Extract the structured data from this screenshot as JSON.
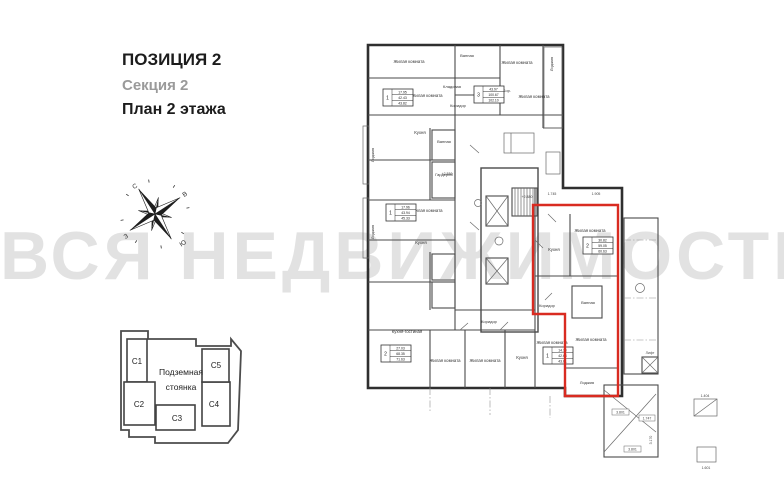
{
  "header": {
    "title": "ПОЗИЦИЯ 2",
    "subtitle": "Секция 2",
    "plan_label": "План 2 этажа"
  },
  "watermark": {
    "text": "ВСЯ НЕДВИЖИМОСТЬ",
    "color": "#e2e2e2"
  },
  "compass": {
    "north": "С",
    "east": "В",
    "west": "З",
    "south": "Ю"
  },
  "minimap": {
    "parking_line1": "Подземная",
    "parking_line2": "стоянка",
    "highlight_fill": "#a8a8a8",
    "sections": [
      {
        "label": "С1"
      },
      {
        "label": "С2"
      },
      {
        "label": "С3"
      },
      {
        "label": "С4"
      },
      {
        "label": "С5"
      }
    ],
    "highlighted": "С2"
  },
  "plan": {
    "highlight_color": "#d92b21",
    "levels": {
      "l1": "+2.880",
      "l2": "+2.880"
    },
    "lift_label": "Лифт",
    "dims": {
      "d1": "1.745",
      "d2": "1.905",
      "d3": "3.801",
      "d4": "1.747",
      "d5": "3.170",
      "d6": "3.801",
      "d9": "1.404",
      "d10": "1.601"
    },
    "apartments": [
      {
        "rooms": "1",
        "a1": "17.95",
        "a2": "42.43",
        "a3": "43.82"
      },
      {
        "rooms": "1",
        "a1": "17.96",
        "a2": "43.94",
        "a3": "45.33"
      },
      {
        "rooms": "3",
        "a1": "43.97",
        "a2": "100.67",
        "a3": "102.10"
      },
      {
        "rooms": "2",
        "a1": "27.03",
        "a2": "68.35",
        "a3": "71.63"
      },
      {
        "rooms": "1",
        "a1": "14.10",
        "a2": "42.64",
        "a3": "43.61"
      },
      {
        "rooms": "2",
        "a1": "30.82",
        "a2": "59.05",
        "a3": "60.63"
      }
    ],
    "rooms": [
      {
        "label": "Жилая комната"
      },
      {
        "label": "Ванная"
      },
      {
        "label": "Жилая комната"
      },
      {
        "label": "Лоджия"
      },
      {
        "label": "Кладовая"
      },
      {
        "label": "Жилая комната"
      },
      {
        "label": "Коридор"
      },
      {
        "label": "Кор."
      },
      {
        "label": "Жилая комната"
      },
      {
        "label": "Кухня"
      },
      {
        "label": "Лоджия"
      },
      {
        "label": "Ванная"
      },
      {
        "label": "Гардероб"
      },
      {
        "label": "Жилая комната"
      },
      {
        "label": "Кухня"
      },
      {
        "label": "Лоджия"
      },
      {
        "label": "Кухня-гостиная"
      },
      {
        "label": "Жилая комната"
      },
      {
        "label": "Жилая комната"
      },
      {
        "label": "Кухня"
      },
      {
        "label": "Жилая комната"
      },
      {
        "label": "Коридор"
      },
      {
        "label": "Коридор"
      },
      {
        "label": "Жилая комната"
      },
      {
        "label": "Кухня"
      },
      {
        "label": "Ванная"
      },
      {
        "label": "Жилая комната"
      },
      {
        "label": "Лоджия"
      },
      {
        "label": "Лифт"
      }
    ]
  }
}
